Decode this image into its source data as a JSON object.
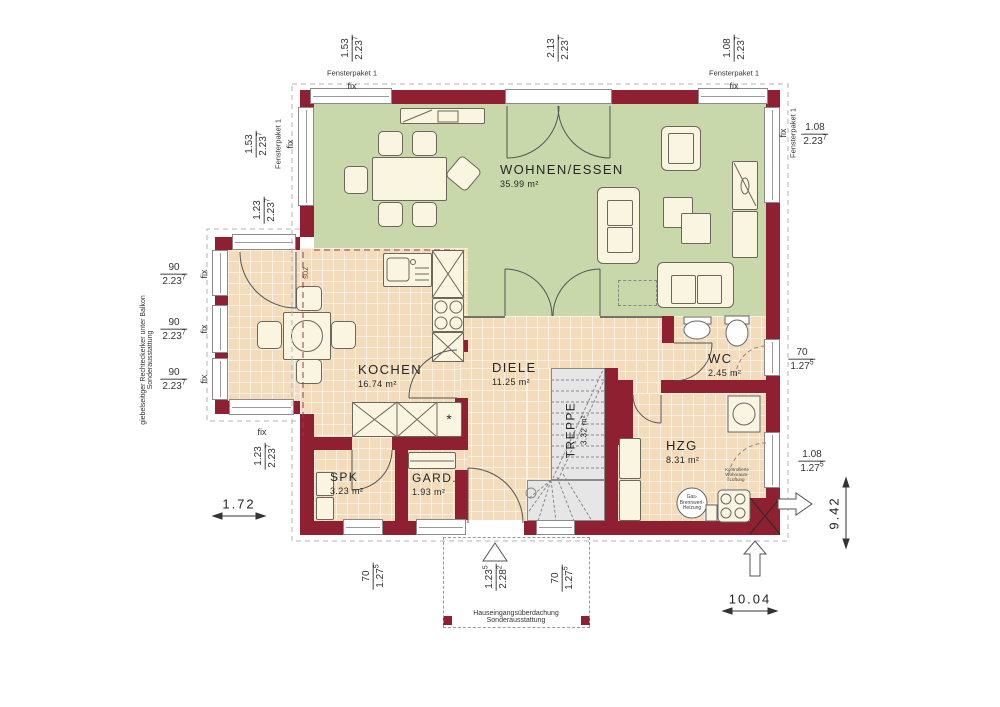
{
  "rooms": {
    "wohnen": {
      "name": "WOHNEN/ESSEN",
      "area": "35.99 m²"
    },
    "kochen": {
      "name": "KOCHEN",
      "area": "16.74 m²"
    },
    "diele": {
      "name": "DIELE",
      "area": "11.25 m²"
    },
    "wc": {
      "name": "WC",
      "area": "2.45 m²"
    },
    "hzg": {
      "name": "HZG",
      "area": "8.31 m²"
    },
    "treppe": {
      "name": "TREPPE",
      "area": "3.32 m²"
    },
    "spk": {
      "name": "SPK",
      "area": "3.23 m²"
    },
    "gard": {
      "name": "GARD.",
      "area": "1.93 m²"
    }
  },
  "dims": {
    "t1": {
      "a": "1.53",
      "b": "2.23",
      "bs": "7"
    },
    "t2": {
      "a": "2.13",
      "b": "2.23",
      "bs": "7"
    },
    "t3": {
      "a": "1.08",
      "b": "2.23",
      "bs": "7"
    },
    "l1": {
      "a": "1.53",
      "b": "2.23",
      "bs": "7"
    },
    "l2": {
      "a": "1.23",
      "b": "2.23",
      "bs": "7"
    },
    "l3": {
      "a": "90",
      "b": "2.23",
      "bs": "7"
    },
    "l4": {
      "a": "90",
      "b": "2.23",
      "bs": "7"
    },
    "l5": {
      "a": "90",
      "b": "2.23",
      "bs": "7"
    },
    "l6": {
      "a": "1.23",
      "b": "2.23",
      "bs": "7"
    },
    "b1": {
      "a": "70",
      "b": "1.27",
      "bs": "5"
    },
    "b2": {
      "a": "1.23",
      "as": "5",
      "b": "2.28",
      "bs": "2"
    },
    "b3": {
      "a": "70",
      "b": "1.27",
      "bs": "5"
    },
    "r1": {
      "a": "1.08",
      "b": "2.23",
      "bs": "7"
    },
    "r2": {
      "a": "70",
      "b": "1.27",
      "bs": "5"
    },
    "r3": {
      "a": "1.08",
      "b": "1.27",
      "bs": "5"
    }
  },
  "overall": {
    "width": "10.04",
    "depth": "9.42",
    "erker_depth": "1.72"
  },
  "labels": {
    "fix": "fix",
    "fensterpaket": "Fensterpaket 1",
    "erker_note_1": "giebelseitiger Rechteckerker unter Balkon",
    "erker_note_2": "Sonderausstattung",
    "canopy_note_1": "Hauseingangsüberdachung",
    "canopy_note_2": "Sonderausstattung",
    "beam": "SUZ",
    "dishwasher": "*",
    "boiler_1": "Gas-",
    "boiler_2": "Brennwert-",
    "boiler_3": "Heizung",
    "vent_1": "Kontrollierte",
    "vent_2": "Wohnraum-",
    "vent_3": "Lüftung"
  },
  "colors": {
    "wall": "#8e2031",
    "living": "#c8d8aa",
    "tile": "#f3dcbc",
    "stairs": "#e6e6e6"
  }
}
